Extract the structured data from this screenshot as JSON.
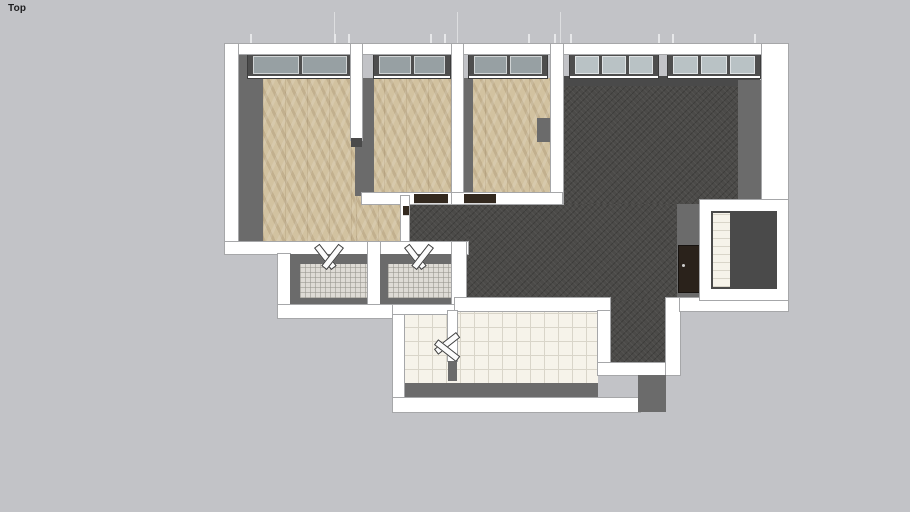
{
  "viewport": {
    "label": "Top",
    "view": "top"
  },
  "colors": {
    "bg": "#c2c3c7",
    "wall": "#ffffff",
    "wallLine": "#a6a7a9",
    "face": "#6b6b6b",
    "faceDark": "#4a4a4a",
    "wood": "#d2c2a0",
    "dark": "#4b4a48",
    "tileSm": "#dedbd5",
    "tileLg": "#f6f3ea",
    "tileLine": "#d9d5c9",
    "glassDim": "#97a0a3",
    "glassLight": "#b9c2c5",
    "frame": "#4e4e4e",
    "doorDark": "#33291f"
  },
  "scene": {
    "type": "apartment-floor-plan-3d-top-view",
    "rooms": [
      {
        "id": "bedroom-left",
        "floor": "herringbone-parquet",
        "floor_color": "#d2c2a0",
        "windows": 1
      },
      {
        "id": "bedroom-middle",
        "floor": "herringbone-parquet",
        "floor_color": "#d2c2a0",
        "windows": 1
      },
      {
        "id": "bedroom-right",
        "floor": "herringbone-parquet",
        "floor_color": "#d2c2a0",
        "windows": 1
      },
      {
        "id": "hallway",
        "floor": "herringbone-parquet",
        "floor_color": "#d2c2a0",
        "windows": 0
      },
      {
        "id": "living-room",
        "floor": "dark-carpet",
        "floor_color": "#4b4a48",
        "windows": 2
      },
      {
        "id": "bathroom-left",
        "floor": "mosaic-tile",
        "floor_color": "#dedbd5",
        "windows": 0
      },
      {
        "id": "bathroom-right",
        "floor": "mosaic-tile",
        "floor_color": "#dedbd5",
        "windows": 0
      },
      {
        "id": "kitchen",
        "floor": "white-tile",
        "floor_color": "#f6f3ea",
        "windows": 0
      },
      {
        "id": "utility-niche",
        "floor": "white-tile-strip",
        "floor_color": "#575757",
        "windows": 0
      }
    ],
    "window_count": 5,
    "door_count": 6
  }
}
